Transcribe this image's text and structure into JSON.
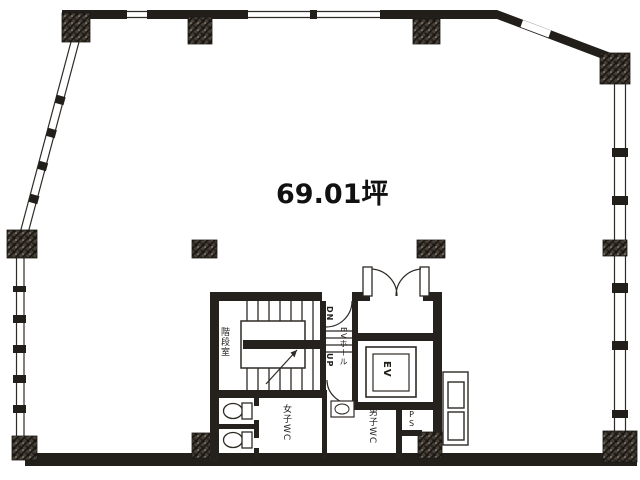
{
  "plan": {
    "title": "office floor plan",
    "area_label": "69.01坪",
    "rooms": {
      "stairwell": "階段室",
      "ev_hall": "EVホール",
      "elevator": "EV",
      "womens_wc": "女子WC",
      "mens_wc": "男子WC",
      "pipe_space": "PS",
      "stair_down": "DN",
      "stair_up": "UP"
    },
    "colors": {
      "wall": "#221e1a",
      "line": "#2e2a25",
      "column_hatch_base": "#453f37",
      "background": "#ffffff",
      "text": "#111111"
    }
  }
}
